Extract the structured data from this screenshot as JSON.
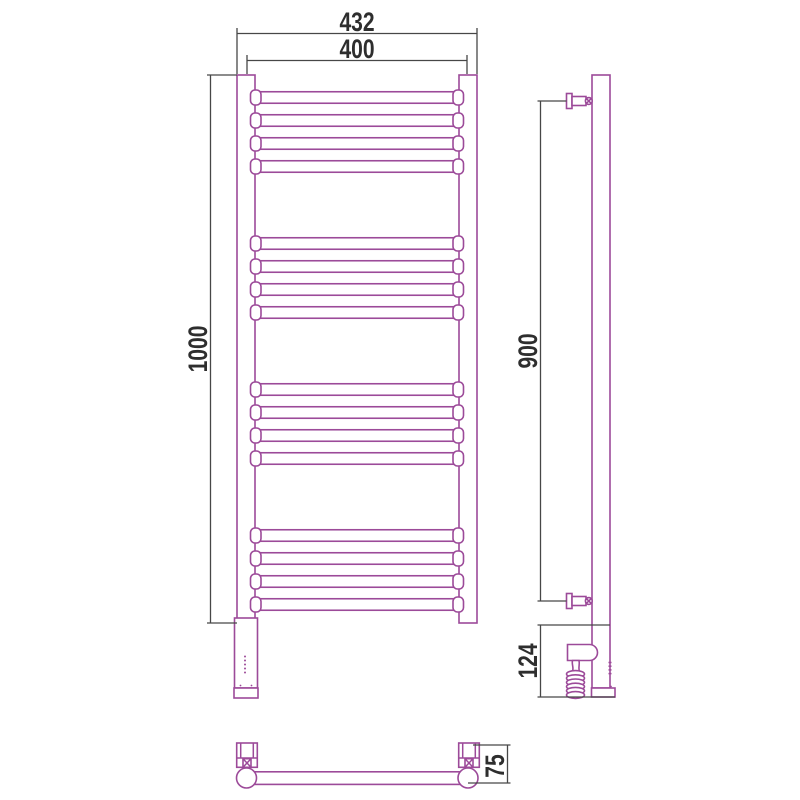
{
  "drawing": {
    "type": "technical dimension drawing of ladder-style heated towel rail",
    "views": [
      "front",
      "side",
      "bottom"
    ]
  },
  "labels": {
    "overall_width": "432",
    "center_width": "400",
    "overall_height": "1000",
    "bracket_spacing": "900",
    "heater_section_height": "124",
    "wall_offset": "75"
  },
  "front_view": {
    "rung_groups": 4,
    "rungs_per_group": 4,
    "indicator_dots": 5
  },
  "side_view": {
    "coil_turns": 6,
    "indicator_dashes": 4
  },
  "colors": {
    "outline": "#9c4a99",
    "dimension_line": "#474747",
    "text": "#2e2e2e",
    "background": "#ffffff"
  }
}
